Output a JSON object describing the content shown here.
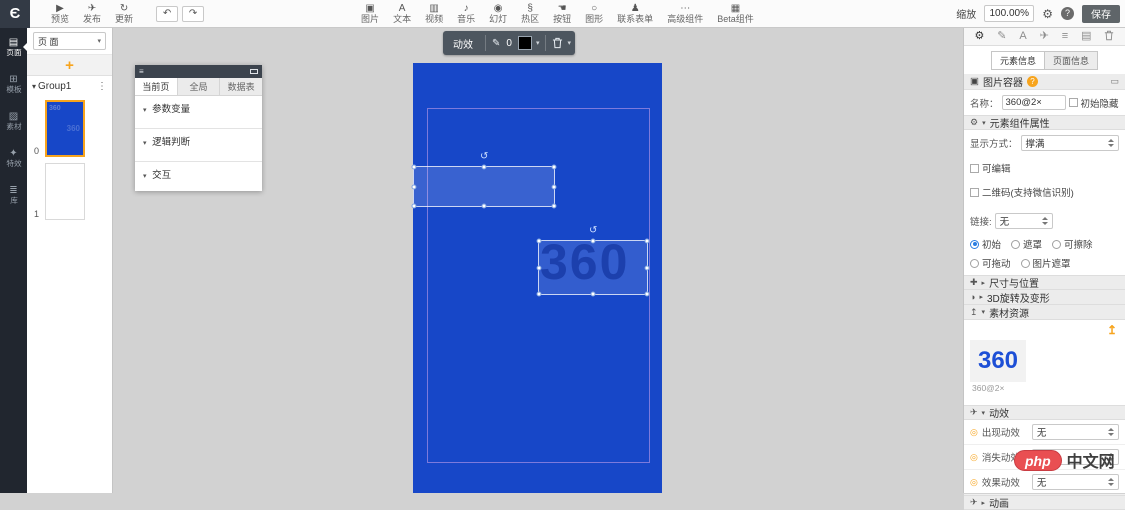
{
  "glyphs": {
    "caret_down": "▾",
    "caret_right": "▸",
    "more": "⋮",
    "menu": "≡",
    "minimize": "▭",
    "rotate": "↺",
    "pencil": "✎",
    "gear": "⚙",
    "bullet": "◎",
    "plus_cross": "✚",
    "sphere": "◑",
    "upload": "↥",
    "plane": "✈",
    "doc": "▤",
    "list": "≡",
    "letter_a": "A",
    "help": "?",
    "undo": "↶",
    "redo": "↷",
    "add": "+"
  },
  "topbar": {
    "logo": "Є",
    "file_items": [
      {
        "label": "预览",
        "glyph": "▶"
      },
      {
        "label": "发布",
        "glyph": "✈"
      },
      {
        "label": "更新",
        "glyph": "↻"
      }
    ],
    "insert_items": [
      {
        "label": "图片",
        "glyph": "▣"
      },
      {
        "label": "文本",
        "glyph": "A"
      },
      {
        "label": "视频",
        "glyph": "▥"
      },
      {
        "label": "音乐",
        "glyph": "♪"
      },
      {
        "label": "幻灯",
        "glyph": "◉"
      },
      {
        "label": "热区",
        "glyph": "§"
      },
      {
        "label": "按钮",
        "glyph": "☚"
      },
      {
        "label": "图形",
        "glyph": "○"
      },
      {
        "label": "联系表单",
        "glyph": "♟"
      },
      {
        "label": "高级组件",
        "glyph": "⋯"
      },
      {
        "label": "Beta组件",
        "glyph": "▦"
      }
    ],
    "zoom_label": "缩放",
    "zoom_value": "100.00%",
    "save_label": "保存"
  },
  "left_rail": {
    "items": [
      {
        "label": "页面",
        "glyph": "▤"
      },
      {
        "label": "模板",
        "glyph": "⊞"
      },
      {
        "label": "素材",
        "glyph": "▨"
      },
      {
        "label": "特效",
        "glyph": "✦"
      },
      {
        "label": "库",
        "glyph": "≣"
      }
    ]
  },
  "pages_panel": {
    "selector_value": "页 面",
    "group_label": "Group1",
    "pages": [
      {
        "index": "0"
      },
      {
        "index": "1"
      }
    ],
    "thumb_text": "360"
  },
  "canvas": {
    "toolbar": {
      "anim_label": "动效",
      "stroke_value": "0"
    },
    "artboard_text": "360"
  },
  "logic_panel": {
    "tabs": [
      {
        "label": "当前页"
      },
      {
        "label": "全局"
      },
      {
        "label": "数据表"
      }
    ],
    "sections": [
      {
        "label": "参数变量"
      },
      {
        "label": "逻辑判断"
      },
      {
        "label": "交互"
      }
    ]
  },
  "inspector": {
    "tabs": [
      {
        "label": "元素信息"
      },
      {
        "label": "页面信息"
      }
    ],
    "component": {
      "icon_glyph": "▣",
      "title": "图片容器",
      "name_label": "名称：",
      "name_value": "360@2×",
      "hidden_label": "初始隐藏"
    },
    "props_section_label": "元素组件属性",
    "display_label": "显示方式：",
    "display_value": "撑满",
    "editable_label": "可编辑",
    "qrcode_label": "二维码(支持微信识别)",
    "link_label": "链接:",
    "link_value": "无",
    "radios": [
      {
        "label": "初始"
      },
      {
        "label": "遮罩"
      },
      {
        "label": "可擦除"
      },
      {
        "label": "可拖动"
      },
      {
        "label": "图片遮罩"
      }
    ],
    "size_section_label": "尺寸与位置",
    "rotate_section_label": "3D旋转及变形",
    "assets_section_label": "素材资源",
    "asset_thumb_text": "360",
    "asset_thumb_caption": "360@2×",
    "effects_section_label": "动效",
    "effect_rows": [
      {
        "label": "出现动效",
        "value": "无"
      },
      {
        "label": "消失动效",
        "value": "无"
      },
      {
        "label": "效果动效",
        "value": "无"
      }
    ],
    "animation_section_label": "动画"
  },
  "watermark": {
    "badge": "php",
    "text": "中文网"
  }
}
